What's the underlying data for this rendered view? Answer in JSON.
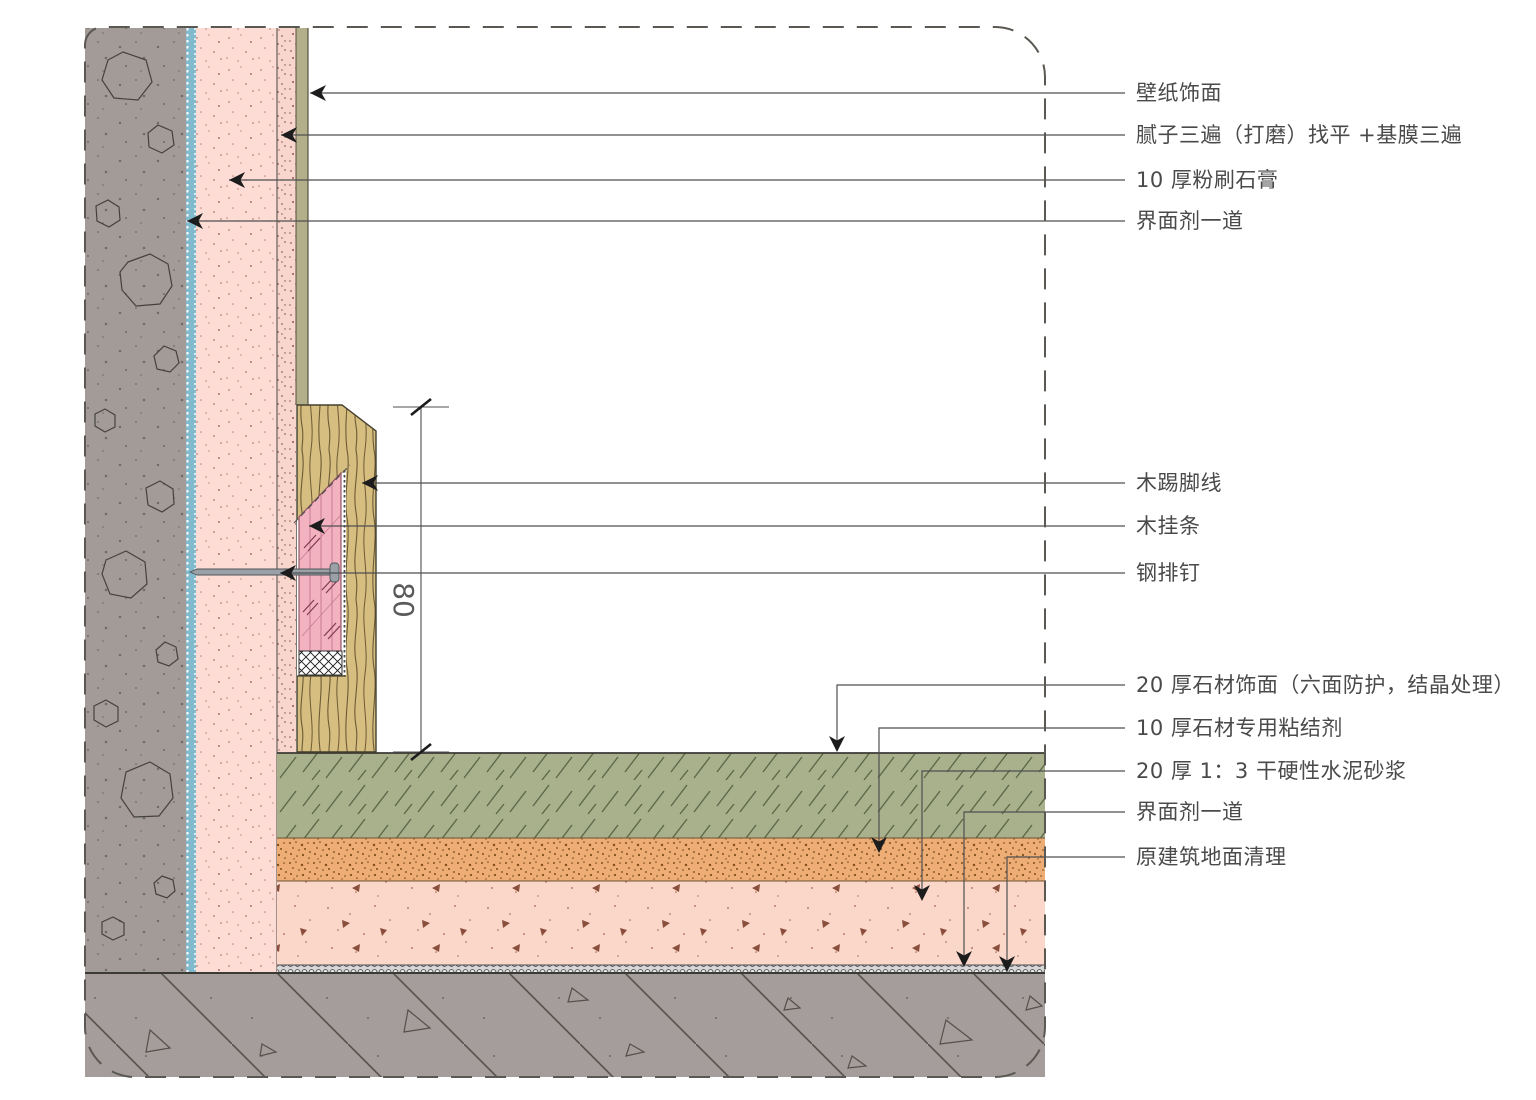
{
  "labels": [
    {
      "text": "壁纸饰面"
    },
    {
      "text": "腻子三遍（打磨）找平 +基膜三遍"
    },
    {
      "text": "10 厚粉刷石膏"
    },
    {
      "text": "界面剂一道"
    },
    {
      "text": "木踢脚线"
    },
    {
      "text": "木挂条"
    },
    {
      "text": "钢排钉"
    },
    {
      "text": "20 厚石材饰面（六面防护，结晶处理）"
    },
    {
      "text": "10 厚石材专用粘结剂"
    },
    {
      "text": "20 厚 1：3 干硬性水泥砂浆"
    },
    {
      "text": "界面剂一道"
    },
    {
      "text": "原建筑地面清理"
    }
  ],
  "dimension": {
    "value": "80"
  },
  "colors": {
    "concrete": "#a29b97",
    "interface_blue": "#82bacd",
    "plaster_pink": "#fcdcd4",
    "putty_pink": "#f8d6ce",
    "wallpaper_olive": "#b2af8a",
    "wood_tan": "#d6bd80",
    "batten_pink": "#f2b2c0",
    "stone_olive": "#a9b18c",
    "adhesive_orange": "#edad74",
    "mortar_pink": "#fbd7ca",
    "slab_gray": "#a49d9b",
    "line_dark": "#4f4f4f"
  }
}
